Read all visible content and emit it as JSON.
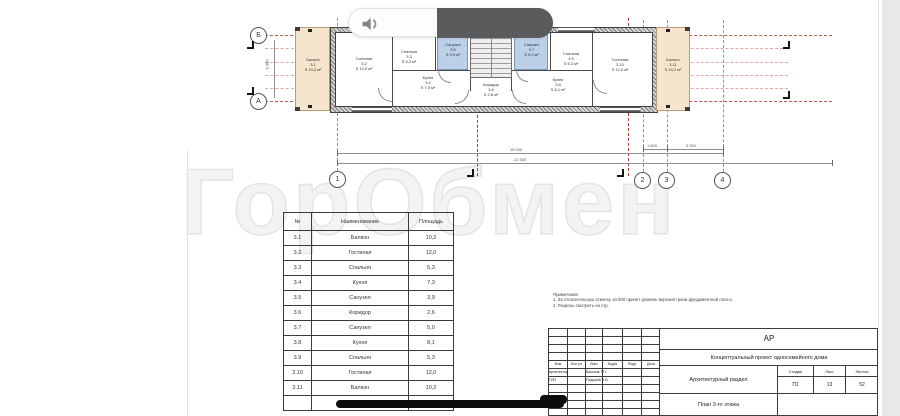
{
  "watermark": "ГорОбмен",
  "os_overlay": {
    "volume_indicator": {
      "icon": "speaker-icon"
    },
    "home_indicator": true
  },
  "plan": {
    "axis_rows": [
      "Б",
      "А"
    ],
    "axis_cols": [
      "1",
      "2",
      "3",
      "4"
    ],
    "dims": {
      "top_width": "16 000",
      "total_width": "22 500",
      "d23": "1 800",
      "d34": "3 500",
      "height": "6 000"
    },
    "rooms": [
      {
        "name": "Балкон",
        "num": "3.1",
        "area": "S 10,2 м²"
      },
      {
        "name": "Гостиная",
        "num": "3.2",
        "area": "S 12,0 м²"
      },
      {
        "name": "Спальня",
        "num": "3.3",
        "area": "S 5,3 м²"
      },
      {
        "name": "Кухня",
        "num": "3.4",
        "area": "S 7,3 м²"
      },
      {
        "name": "Санузел",
        "num": "3.5",
        "area": "S 3,9 м²"
      },
      {
        "name": "Коридор",
        "num": "3.6",
        "area": "S 2,6 м²"
      },
      {
        "name": "Санузел",
        "num": "3.7",
        "area": "S 5,0 м²"
      },
      {
        "name": "Кухня",
        "num": "3.8",
        "area": "S 8,1 м²"
      },
      {
        "name": "Спальня",
        "num": "3.9",
        "area": "S 5,3 м²"
      },
      {
        "name": "Гостиная",
        "num": "3.10",
        "area": "S 12,0 м²"
      },
      {
        "name": "Балкон",
        "num": "3.11",
        "area": "S 10,2 м²"
      }
    ]
  },
  "table": {
    "headers": [
      "№",
      "Наименование",
      "Площадь"
    ],
    "rows": [
      [
        "3.1",
        "Балкон",
        "10,2"
      ],
      [
        "3.2",
        "Гостиная",
        "12,0"
      ],
      [
        "3.3",
        "Спальня",
        "5,3"
      ],
      [
        "3.4",
        "Кухня",
        "7,3"
      ],
      [
        "3.5",
        "Санузел",
        "3,9"
      ],
      [
        "3.6",
        "Коридор",
        "2,6"
      ],
      [
        "3.7",
        "Санузел",
        "5,0"
      ],
      [
        "3.8",
        "Кухня",
        "8,1"
      ],
      [
        "3.9",
        "Спальня",
        "5,3"
      ],
      [
        "3.10",
        "Гостиная",
        "12,0"
      ],
      [
        "3.11",
        "Балкон",
        "10,2"
      ]
    ],
    "total": "81,9 м²"
  },
  "notes": {
    "title": "Примечание:",
    "items": [
      "1. За относительную отметку ±0.000 принят уровень верхней грани фундаментной плиты.",
      "2. Разрезы смотреть на стр."
    ]
  },
  "titleblock": {
    "code": "АР",
    "project": "Концептуальный проект односемейного дома",
    "section": "Архитектурный раздел",
    "sheet_title": "План 3-го этажа",
    "rev_cols": [
      "Изм",
      "Кол.уч",
      "Лист",
      "№док",
      "Подп",
      "Дата"
    ],
    "roles": [
      {
        "role": "Архитектор",
        "name": "Бикозов Т.Н."
      },
      {
        "role": "ГИП",
        "name": "Педорой Н.В."
      }
    ],
    "stage": {
      "label": "Стадия",
      "value": "П1"
    },
    "sheet": {
      "label": "Лист",
      "value": "13"
    },
    "sheets": {
      "label": "Листов",
      "value": "52"
    }
  }
}
